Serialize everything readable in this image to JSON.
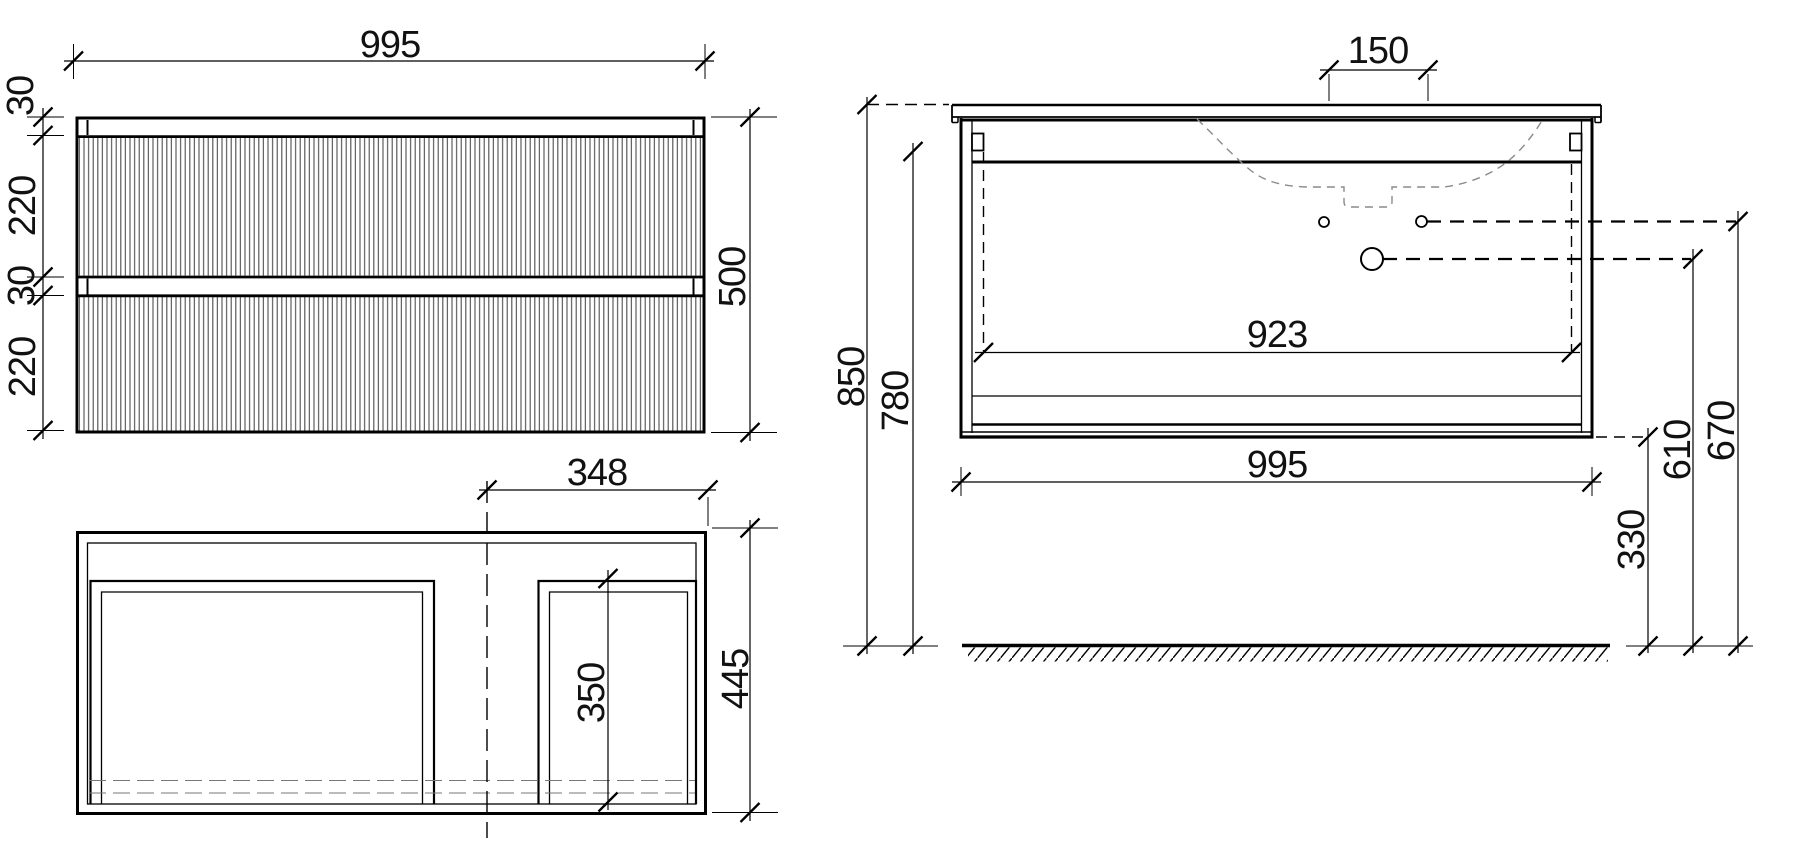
{
  "front_view": {
    "width": "995",
    "top_rail": "30",
    "upper_drawer": "220",
    "drawer_gap": "30",
    "lower_drawer": "220",
    "height": "500"
  },
  "plan_view": {
    "basin_offset": "348",
    "depth": "445",
    "compartment_depth": "350"
  },
  "installation_view": {
    "hole_spacing": "150",
    "overall_height": "850",
    "top_height": "780",
    "interior_width": "923",
    "width": "995",
    "small_hole_height": "670",
    "large_hole_height": "610",
    "bottom_clearance": "330"
  },
  "colors": {
    "line": "#000000",
    "sink_outline": "#8a8a8a",
    "fluting": "#555555",
    "background": "#ffffff"
  }
}
